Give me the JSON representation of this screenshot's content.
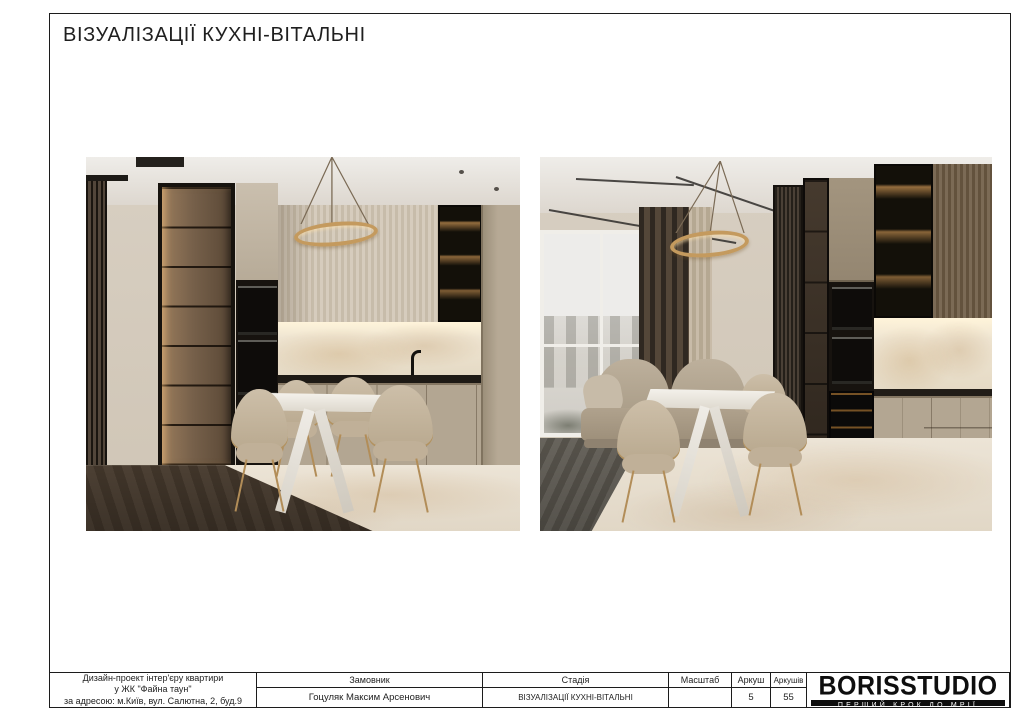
{
  "page": {
    "title": "ВІЗУАЛІЗАЦІЇ КУХНІ-ВІТАЛЬНІ",
    "background": "#ffffff",
    "border_color": "#1c1c1c"
  },
  "images": [
    {
      "name": "kitchen-view-render"
    },
    {
      "name": "living-room-view-render"
    }
  ],
  "titleblock": {
    "project": {
      "line1": "Дизайн-проект інтер'єру квартири",
      "line2": "у ЖК \"Файна таун\"",
      "line3": "за адресою: м.Київ, вул. Салютна, 2, буд.9"
    },
    "customer": {
      "label": "Замовник",
      "value": "Гоцуляк Максим Арсенович"
    },
    "stage": {
      "label": "Стадія",
      "value": "ВІЗУАЛІЗАЦІЇ КУХНІ-ВІТАЛЬНІ"
    },
    "scale": {
      "label": "Масштаб",
      "value": ""
    },
    "sheet": {
      "label": "Аркуш",
      "value": "5"
    },
    "sheets": {
      "label": "Аркушів",
      "value": "55"
    }
  },
  "logo": {
    "name": "BORISSTUDIO",
    "tagline": "ПЕРШИЙ КРОК ДО МРІЇ",
    "bar_color": "#0e0e0e",
    "text_color": "#0e0e0e"
  },
  "palette": {
    "beige_wall": "#d8cfc2",
    "taupe_cabinet": "#b3a692",
    "dark_wood_floor": "#4e4134",
    "bronze_glass": "#5d4b3a",
    "gold_accent": "#c49a5e",
    "marble": "#ece4d6",
    "appliance_black": "#17130f"
  }
}
